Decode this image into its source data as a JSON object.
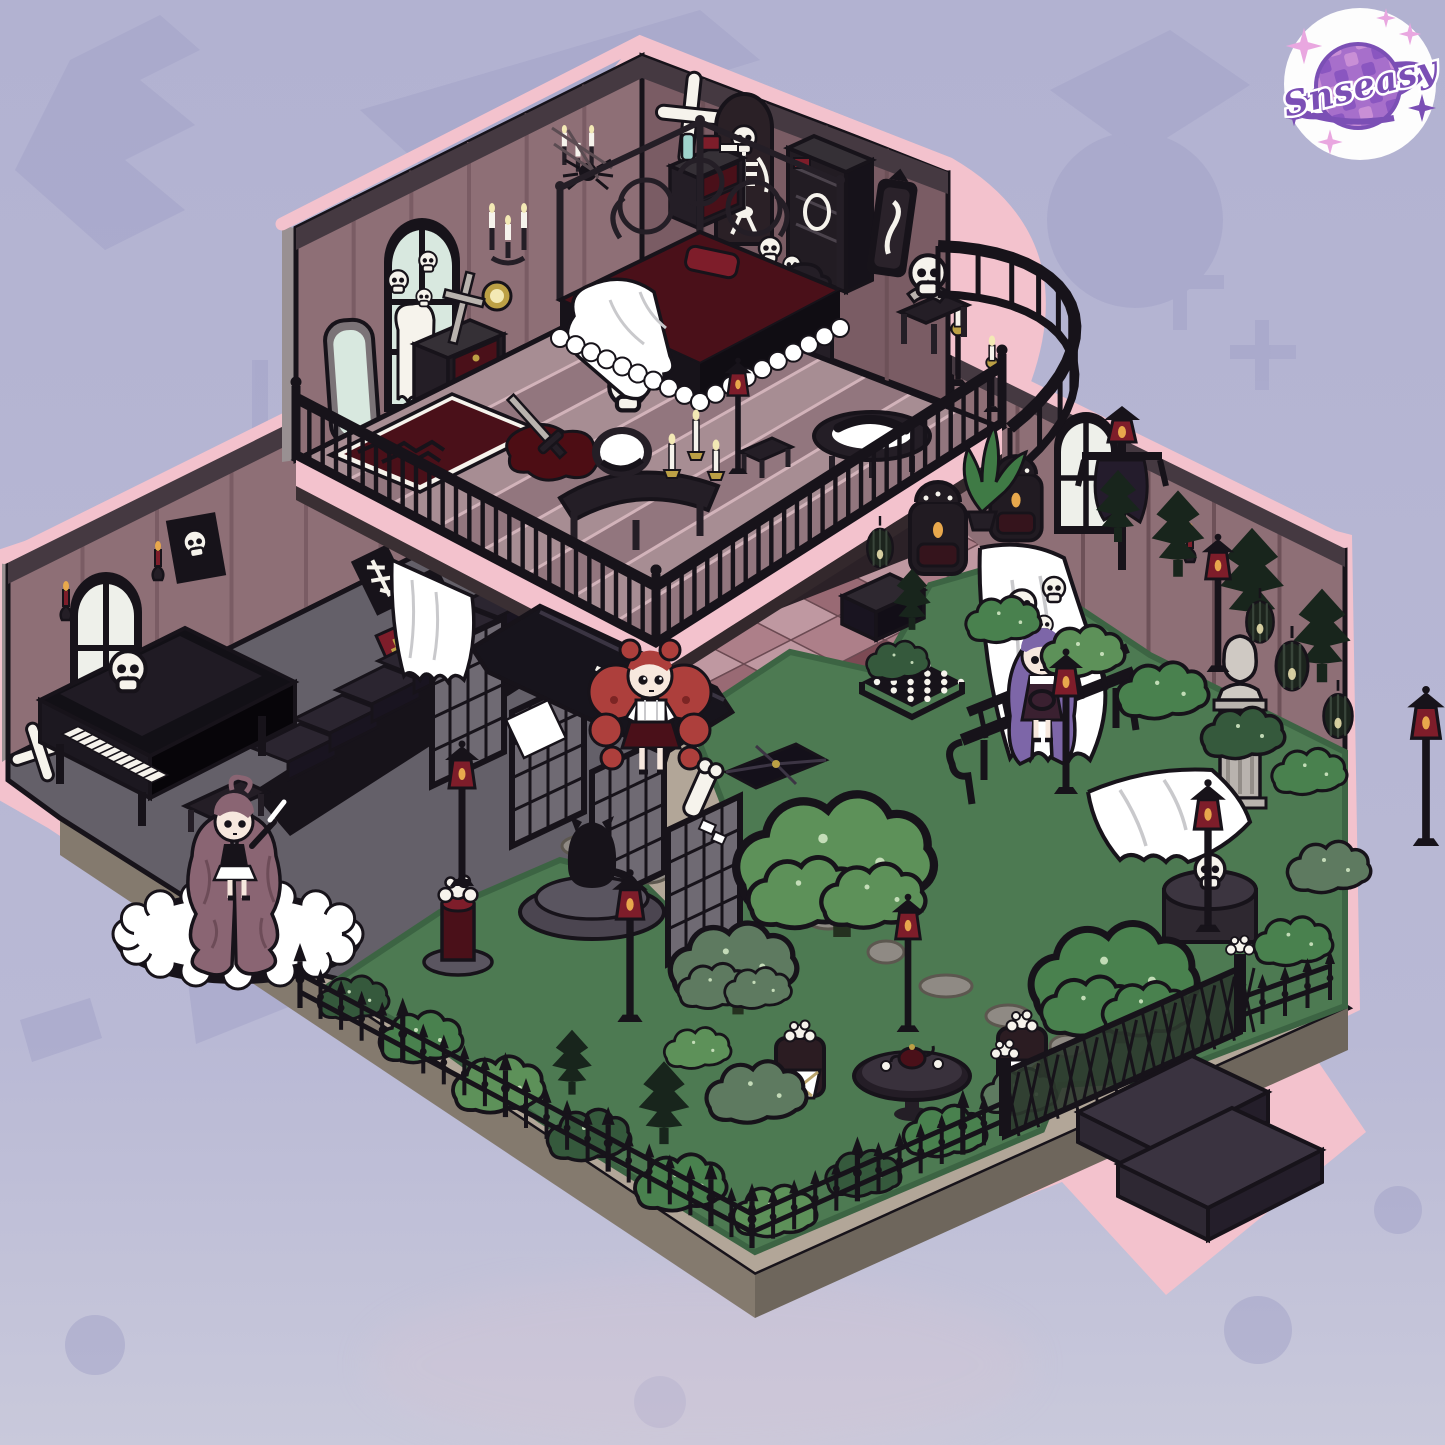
{
  "watermark": {
    "text": "Snseasy"
  },
  "palette": {
    "bg": "#b4b4d2",
    "bgBottom": "#c9c9db",
    "motif": "#a2a2c8",
    "pink": "#f3c2cd",
    "wallMauve": "#8e6f76",
    "wallMauveDark": "#7a5c64",
    "wallTrim": "#453941",
    "wallGray": "#8a8183",
    "wallGraySide": "#999092",
    "floorA": "#a78d93",
    "floorB": "#92767e",
    "stripeLine": "#d2b3ba",
    "floorGray": "#646069",
    "floorGrayDark": "#4b474f",
    "tileLight": "#bf98a1",
    "tileMid": "#ad7f89",
    "tileDark": "#996a74",
    "tileMaroon": "#7c4a54",
    "lawn": "#4d7a52",
    "lawnDark": "#3c6443",
    "bushLight": "#5d9159",
    "bushMid": "#49814e",
    "bushGray": "#5e7a60",
    "bushDark": "#35593c",
    "pine": "#18251c",
    "treeTrunk": "#24301f",
    "ink": "#17131a",
    "furn": "#241e26",
    "soffit": "#2b2127",
    "maroon": "#4a1019",
    "red": "#7e1d2a",
    "gold": "#bca045",
    "flame": "#f3e9b5",
    "glow": "#e8a84c",
    "bone": "#f6f3ec",
    "white": "#ffffff",
    "glass": "#d8e8df",
    "teal": "#9fd3cc",
    "ledge": "#b2a698",
    "ledgeSide": "#847a6e",
    "step": "#3a3340",
    "stepDark": "#241e2a",
    "pathStone": "#8f8a84",
    "stoneCol": "#b9b3ae",
    "hairRed": "#ad3f3c",
    "hairMauve": "#8a6573",
    "hairPurple": "#7d66a8",
    "skin": "#f7e8de",
    "badgePurple": "#7b4fb5",
    "badgePink": "#e9a7e0",
    "checker1": "#8a56c0",
    "checker2": "#c98fd6"
  },
  "scene": {
    "style": "isometric gothic haunted dollhouse diorama",
    "upper_floor": {
      "name": "gothic-bedroom",
      "items": [
        "arched window with ghost and skulls",
        "wall candelabras",
        "gold plate",
        "bone cross",
        "hanging skeleton",
        "black wardrobe",
        "wall mirror",
        "nightstand with potion bottle and red book",
        "black canopy bed with ghost blanket",
        "red throne chair",
        "skull bust on table",
        "vanity table with mirror and candles",
        "blood puddle with sword",
        "patterned rug",
        "standing mirror",
        "dresser with red drawers",
        "floor skull",
        "bassinet with black wreath",
        "boots",
        "balcony balustrade",
        "curved railing with standing candle lamps"
      ]
    },
    "lower_floor": {
      "name": "hall-piano-room-and-garden",
      "items": [
        "grand piano with skull",
        "piano bench",
        "skull poster",
        "arched windows",
        "red candle sconces",
        "crossed bones",
        "staircase",
        "iron lattice screens",
        "white cloud rug",
        "black coffin with white cross",
        "skeleton anatomy posters",
        "red spell book",
        "black cat on stone pedestal",
        "chessboard",
        "black crate",
        "tufted armchairs with candles",
        "potted plant",
        "scarecrow lamp",
        "ghost sheets",
        "garden bench",
        "stone bust column",
        "caged lanterns",
        "dead trees",
        "round trees and bushes",
        "stone path",
        "lamp posts with red lanterns",
        "tea table with teapot",
        "garden chairs",
        "flower pedestal",
        "skull drum table",
        "white flowers",
        "wrought iron spear fence",
        "lattice gate",
        "entry steps"
      ]
    },
    "characters": [
      {
        "name": "girl-with-red-twin-tails",
        "location": "center hall near coffin"
      },
      {
        "name": "girl-with-long-mauve-hair",
        "location": "piano room on white rug"
      },
      {
        "name": "girl-with-purple-hair",
        "location": "garden near bench, skulls floating overhead"
      }
    ]
  }
}
